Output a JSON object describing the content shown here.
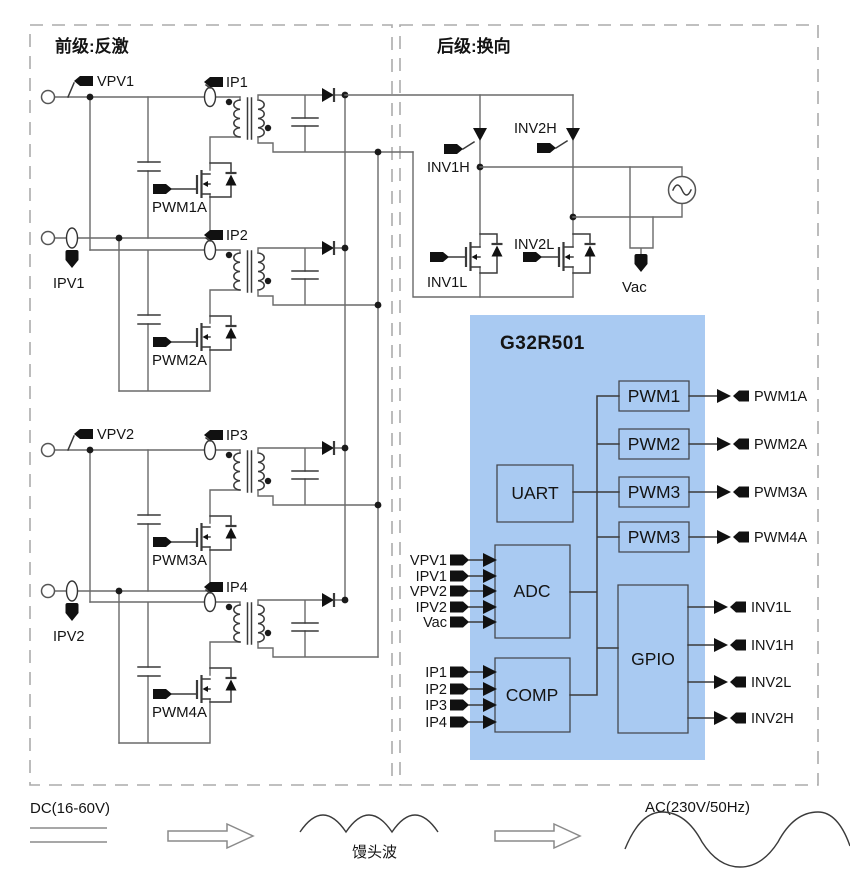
{
  "front_stage": {
    "title": "前级:反激",
    "pv_inputs": [
      {
        "voltage_label": "VPV1",
        "current_label": "IPV1"
      },
      {
        "voltage_label": "VPV2",
        "current_label": "IPV2"
      }
    ],
    "cells": [
      {
        "current_probe": "IP1",
        "gate_label": "PWM1A"
      },
      {
        "current_probe": "IP2",
        "gate_label": "PWM2A"
      },
      {
        "current_probe": "IP3",
        "gate_label": "PWM3A"
      },
      {
        "current_probe": "IP4",
        "gate_label": "PWM4A"
      }
    ]
  },
  "rear_stage": {
    "title": "后级:换向",
    "high_side": [
      "INV1H",
      "INV2H"
    ],
    "low_side": [
      "INV1L",
      "INV2L"
    ],
    "ac_sense_label": "Vac"
  },
  "mcu": {
    "name": "G32R501",
    "uart": "UART",
    "adc": "ADC",
    "comp": "COMP",
    "gpio": "GPIO",
    "pwm_modules": [
      "PWM1",
      "PWM2",
      "PWM3",
      "PWM3"
    ],
    "pwm_outputs": [
      "PWM1A",
      "PWM2A",
      "PWM3A",
      "PWM4A"
    ],
    "adc_inputs": [
      "VPV1",
      "IPV1",
      "VPV2",
      "IPV2",
      "Vac"
    ],
    "comp_inputs": [
      "IP1",
      "IP2",
      "IP3",
      "IP4"
    ],
    "gpio_outputs": [
      "INV1L",
      "INV1H",
      "INV2L",
      "INV2H"
    ]
  },
  "flow": {
    "input": "DC(16-60V)",
    "intermediate": "馒头波",
    "output": "AC(230V/50Hz)"
  },
  "colors": {
    "mcu_fill": "#a9caf2"
  }
}
